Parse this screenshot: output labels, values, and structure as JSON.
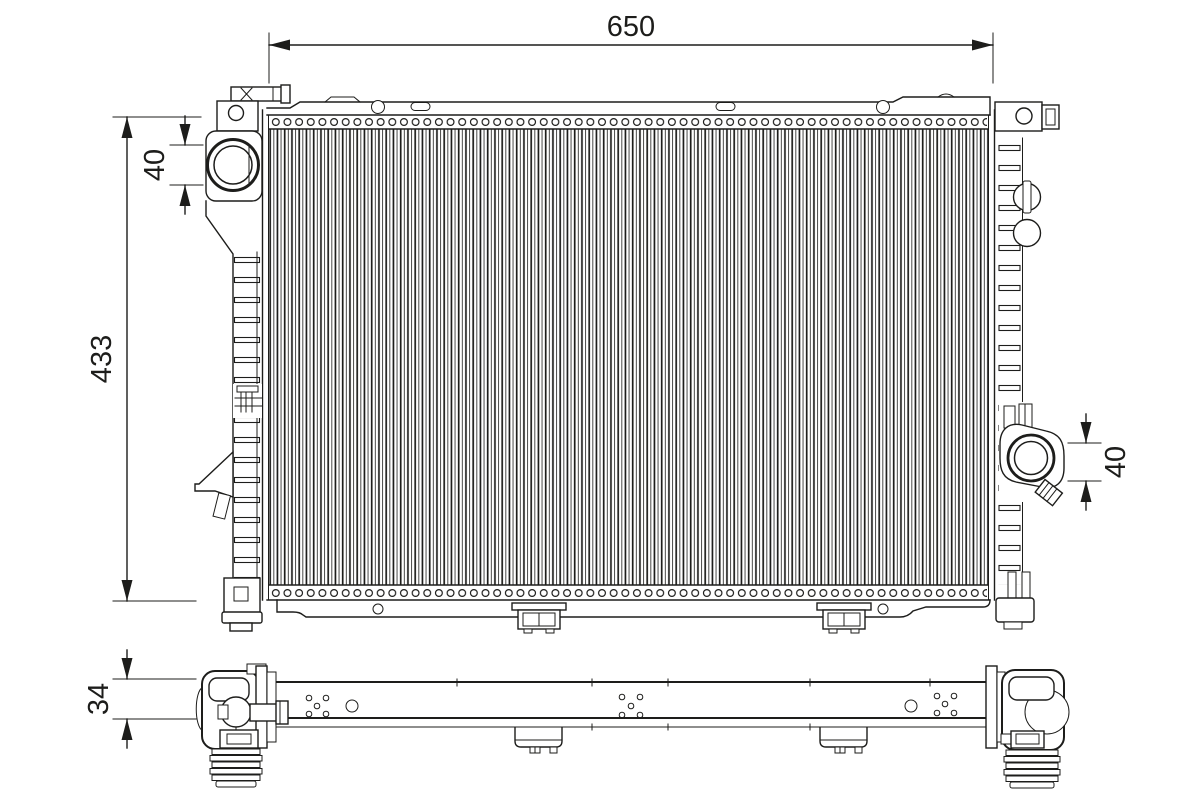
{
  "meta": {
    "background_color": "#ffffff",
    "line_color": "#1d1d1b"
  },
  "dimensions": {
    "width": "650",
    "height": "433",
    "inlet": "40",
    "outlet": "40",
    "depth": "34"
  }
}
